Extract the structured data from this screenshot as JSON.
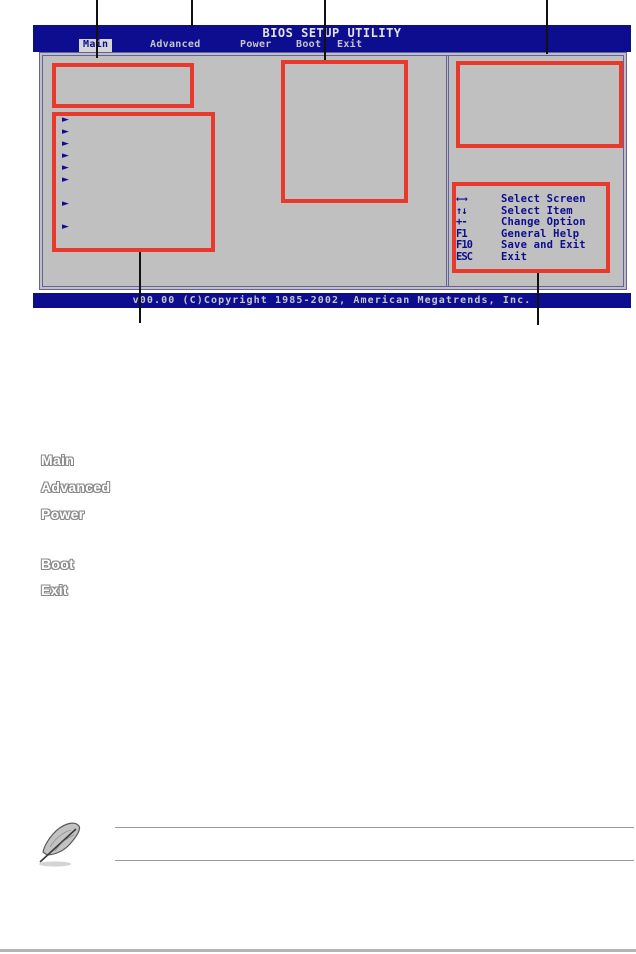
{
  "bios": {
    "title": "BIOS SETUP UTILITY",
    "menu": {
      "items": [
        {
          "label": "Main",
          "active": true
        },
        {
          "label": "Advanced",
          "active": false
        },
        {
          "label": "Power",
          "active": false
        },
        {
          "label": "Boot",
          "active": false
        },
        {
          "label": "Exit",
          "active": false
        }
      ]
    },
    "submenu_arrow_glyph": "►",
    "legend": {
      "rows": [
        {
          "key": "←→",
          "label": "Select Screen"
        },
        {
          "key": "↑↓",
          "label": "Select Item"
        },
        {
          "key": "+-",
          "label": "Change Option"
        },
        {
          "key": "F1",
          "label": "General Help"
        },
        {
          "key": "F10",
          "label": "Save and Exit"
        },
        {
          "key": "ESC",
          "label": "Exit"
        }
      ]
    },
    "copyright": "v00.00 (C)Copyright 1985-2002, American Megatrends, Inc."
  },
  "figure_labels": [
    "Main",
    "Advanced",
    "Power",
    "Boot",
    "Exit"
  ],
  "icons": {
    "note_icon": "quill-pen-note-icon"
  },
  "colors": {
    "callout_red": "#e8392c",
    "bios_navy": "#0d0d8f",
    "bios_gray": "#c0c0c0",
    "menu_text_silver": "#c6c6c6"
  }
}
